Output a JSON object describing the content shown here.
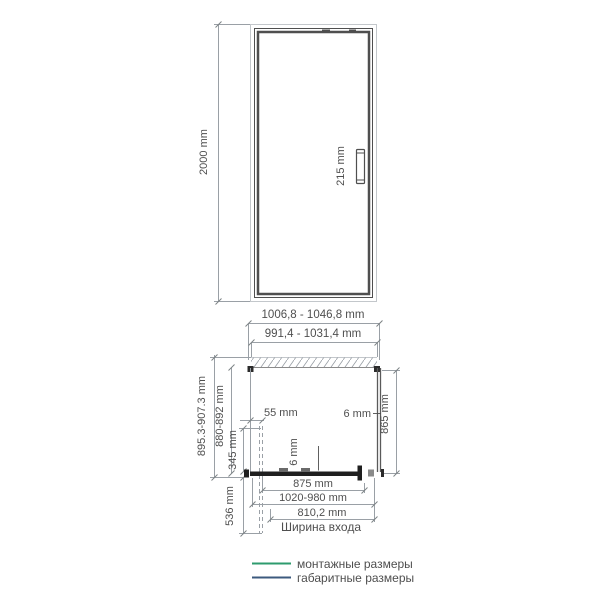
{
  "front_view": {
    "height_dim": "2000 mm",
    "handle_dim": "215 mm"
  },
  "plan_view": {
    "overall_width_dim": "1006,8 - 1046,8 mm",
    "mounting_width_dim": "991,4 - 1031,4 mm",
    "overall_depth_dim": "895.3-907.3 mm",
    "mounting_depth_dim": "880-892 mm",
    "wall_offset_dim": "55 mm",
    "left_fixed_dim": "345 mm",
    "door_swing_dim": "536 mm",
    "side_glass_thickness_dim": "6 mm",
    "side_panel_depth_dim": "865 mm",
    "door_glass_thickness_dim": "6 mm",
    "door_width_dim": "875 mm",
    "width_range_dim": "1020-980 mm",
    "entrance_width_dim": "810,2 mm",
    "entrance_width_caption": "Ширина входа"
  },
  "legend": {
    "mounting_label": "монтажные размеры",
    "overall_label": "габаритные размеры"
  },
  "colors": {
    "mounting_green": "#2e9b6e",
    "overall_navy": "#3c5a7e",
    "drawing_gray": "#4f4f4f",
    "dim_line_gray": "#9aa0a6",
    "legend_text": "#44546a"
  }
}
